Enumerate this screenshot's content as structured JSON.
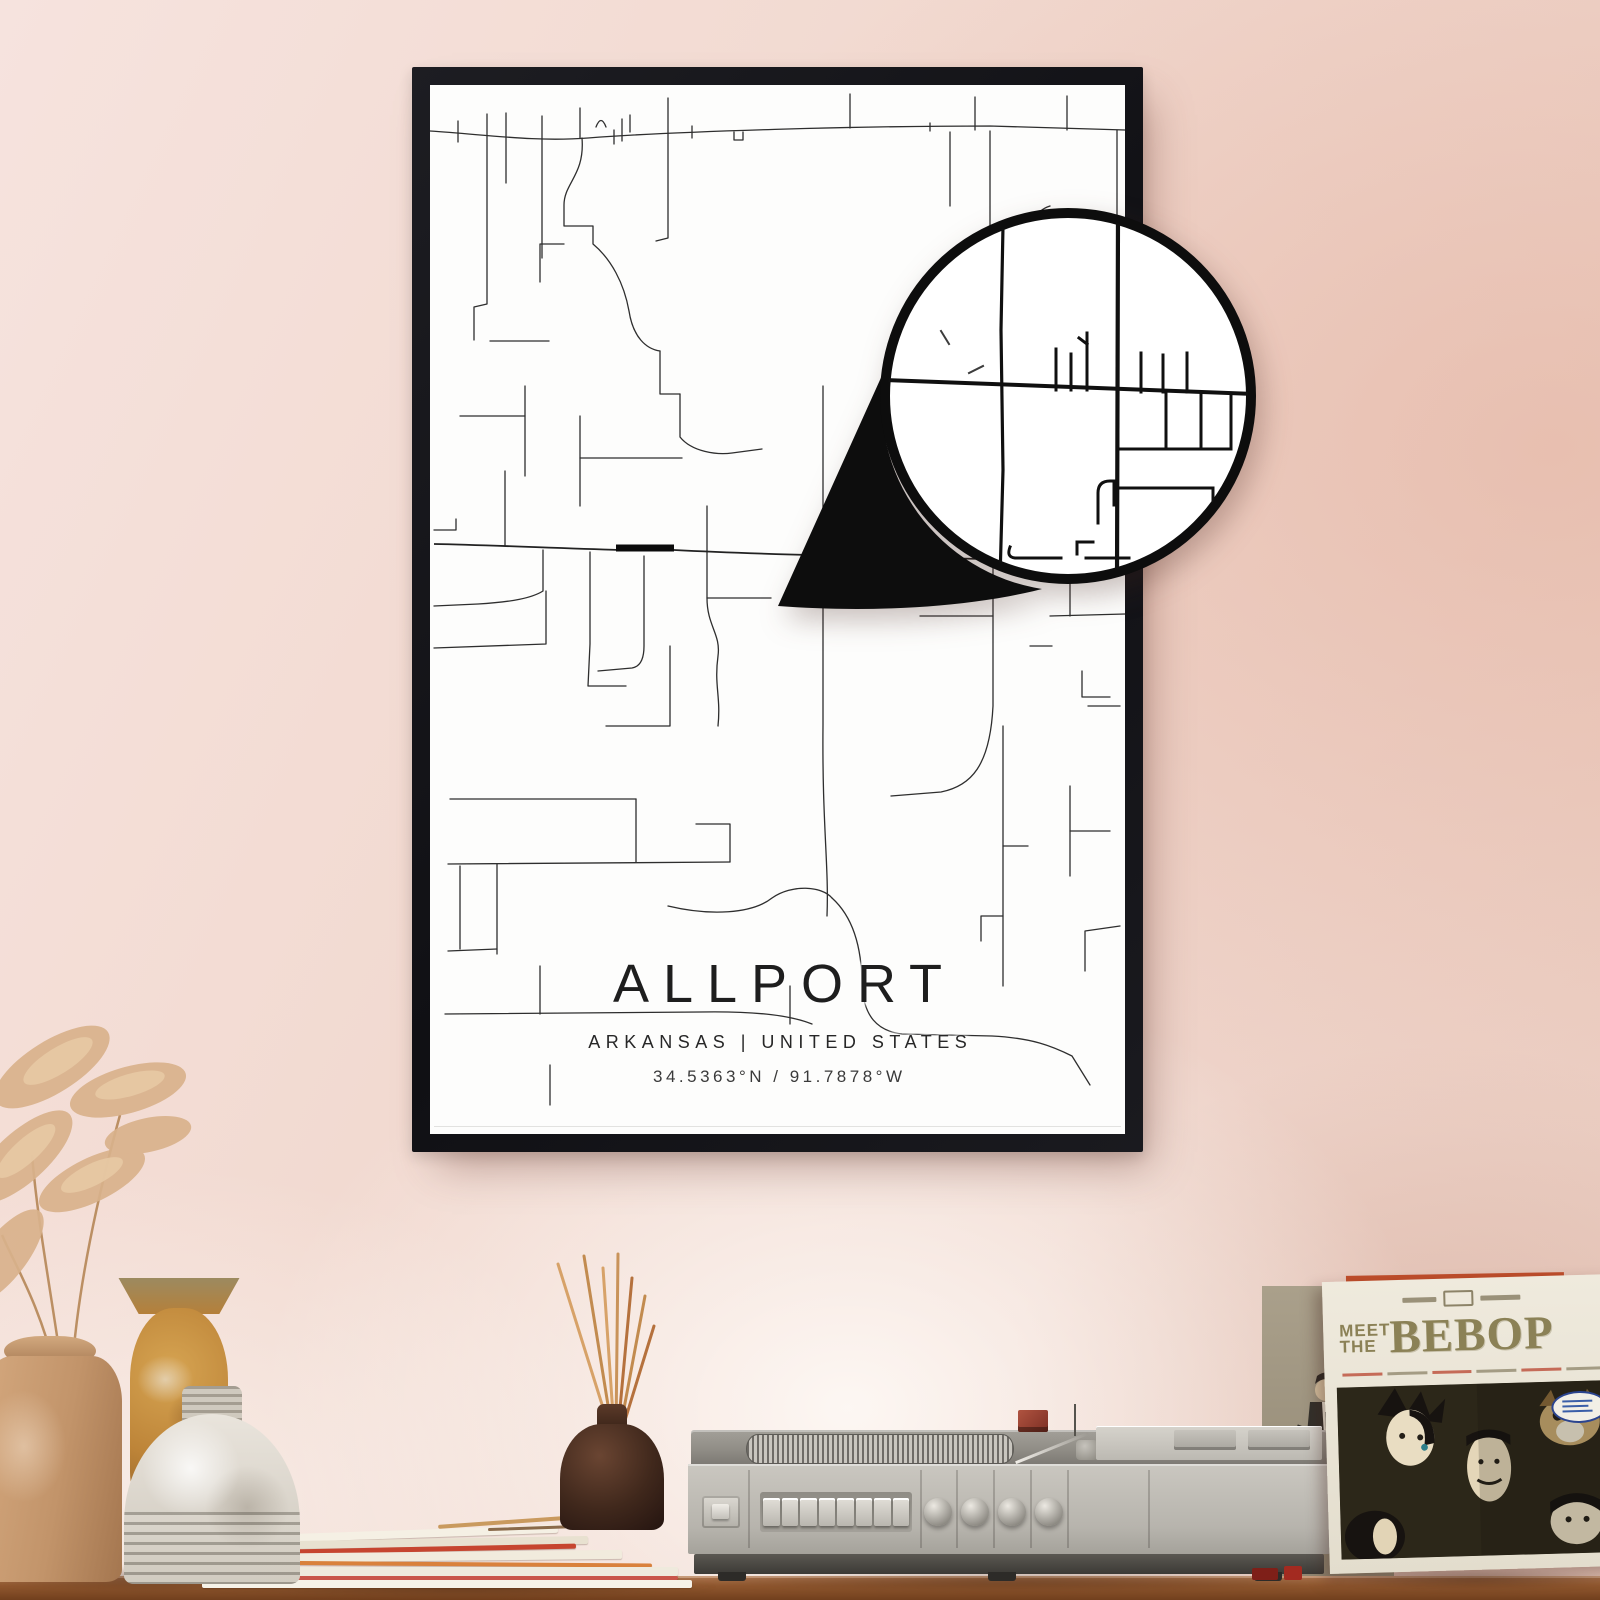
{
  "poster": {
    "title": "ALLPORT",
    "subtitle": "ARKANSAS | UNITED STATES",
    "coordinates": "34.5363°N / 91.7878°W"
  },
  "album": {
    "meet_the": "MEET THE",
    "title": "BEBOP"
  },
  "colors": {
    "wall": "#f1d9d2",
    "frame": "#141418",
    "poster_bg": "#fdfdfc",
    "road": "#2e2e2e",
    "road_bold": "#0b0b0b",
    "album_olive": "#8b8156",
    "table_wood": "#8d5531"
  }
}
